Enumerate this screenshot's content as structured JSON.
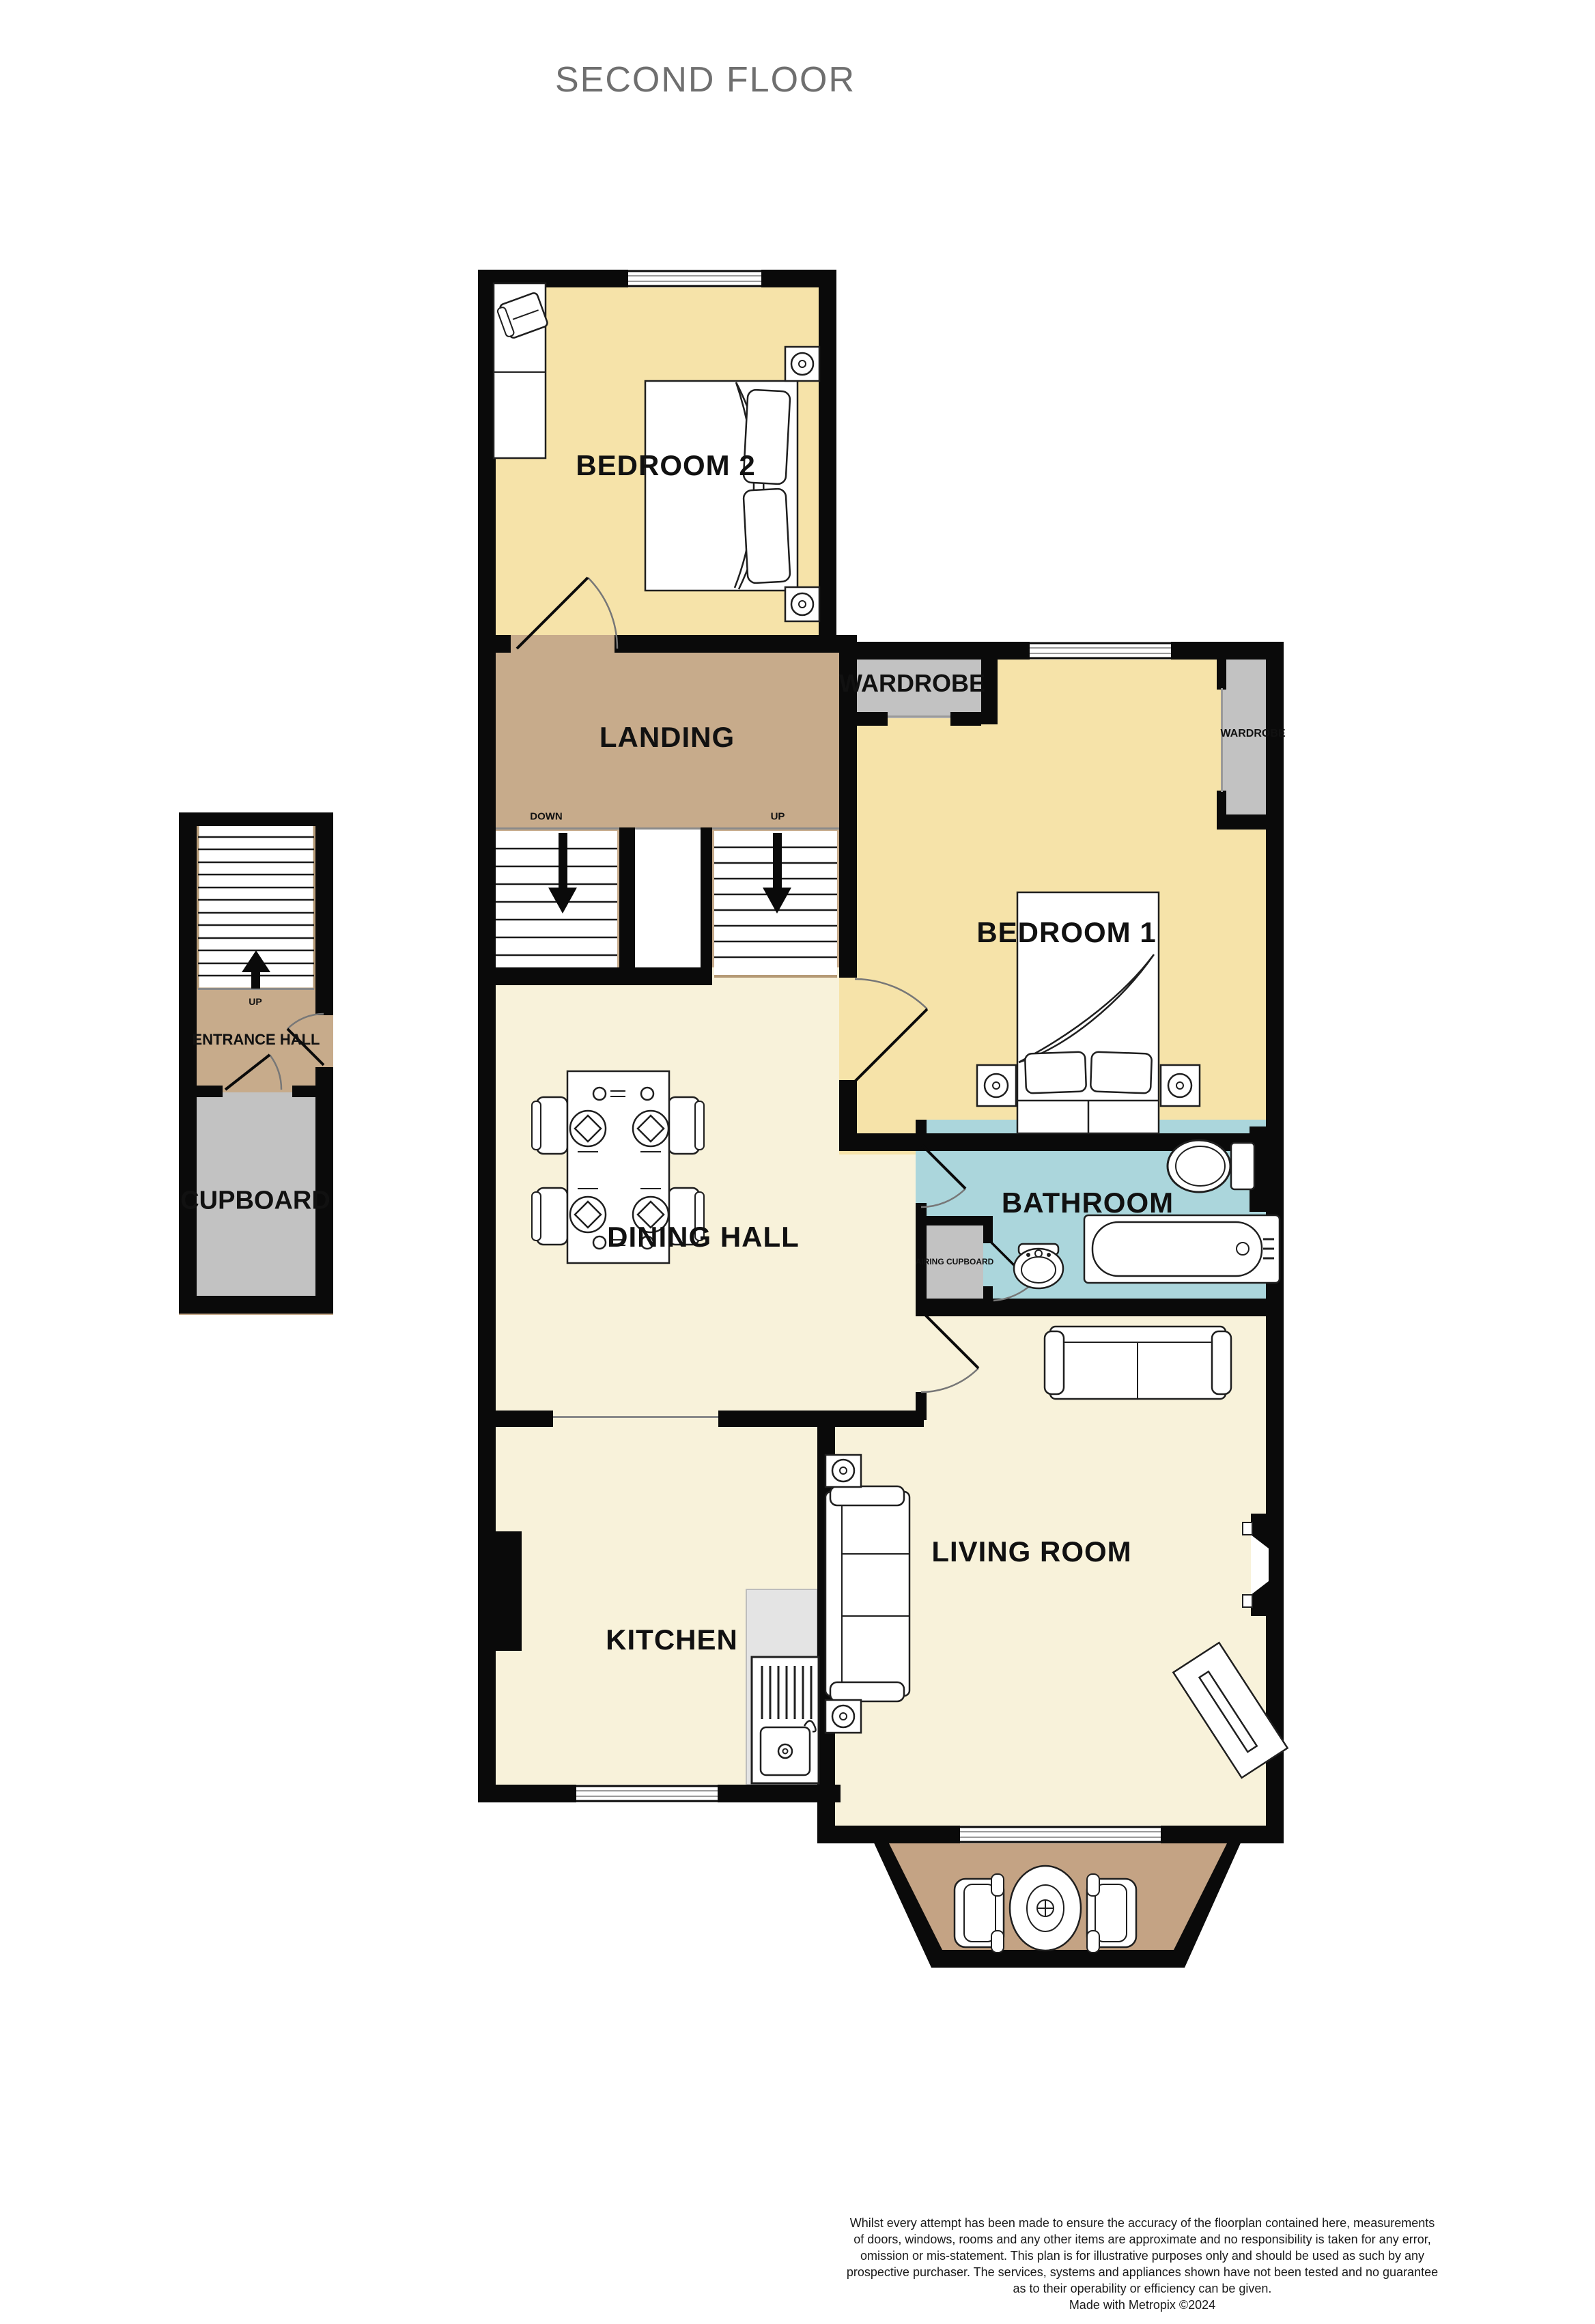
{
  "title": "SECOND FLOOR",
  "rooms": {
    "bedroom2": {
      "label": "BEDROOM 2"
    },
    "landing": {
      "label": "LANDING",
      "down": "DOWN",
      "up": "UP"
    },
    "bedroom1": {
      "label": "BEDROOM 1",
      "wardrobe_left": "WARDROBE",
      "wardrobe_right": "WARDROBE"
    },
    "entrance_hall": {
      "label": "ENTRANCE HALL",
      "up": "UP"
    },
    "cupboard": {
      "label": "CUPBOARD"
    },
    "dining_hall": {
      "label": "DINING HALL"
    },
    "bathroom": {
      "label": "BATHROOM",
      "airing_cupboard": "AIRING CUPBOARD"
    },
    "kitchen": {
      "label": "KITCHEN"
    },
    "living_room": {
      "label": "LIVING ROOM"
    }
  },
  "footer": {
    "lines": [
      "Whilst every attempt has been made to ensure the accuracy of the floorplan contained here, measurements",
      "of doors, windows, rooms and any other items are approximate and no responsibility is taken for any error,",
      "omission or mis-statement. This plan is for illustrative purposes only and should be used as such by any",
      "prospective purchaser. The services, systems and appliances shown have not been tested and no guarantee",
      "as to their operability or efficiency can be given."
    ],
    "credit": "Made with Metropix ©2024"
  },
  "colors": {
    "wall": "#0a0a0a",
    "bedroom_fill": "#f6e3a9",
    "hall_fill": "#c7ab8b",
    "cream_fill": "#f8f2da",
    "gray_fill": "#c2c2c2",
    "bathroom_fill": "#abd6dc",
    "counter_fill": "#e4e4e4",
    "balcony_fill": "#c4a384",
    "title_gray": "#6f6f6f"
  }
}
